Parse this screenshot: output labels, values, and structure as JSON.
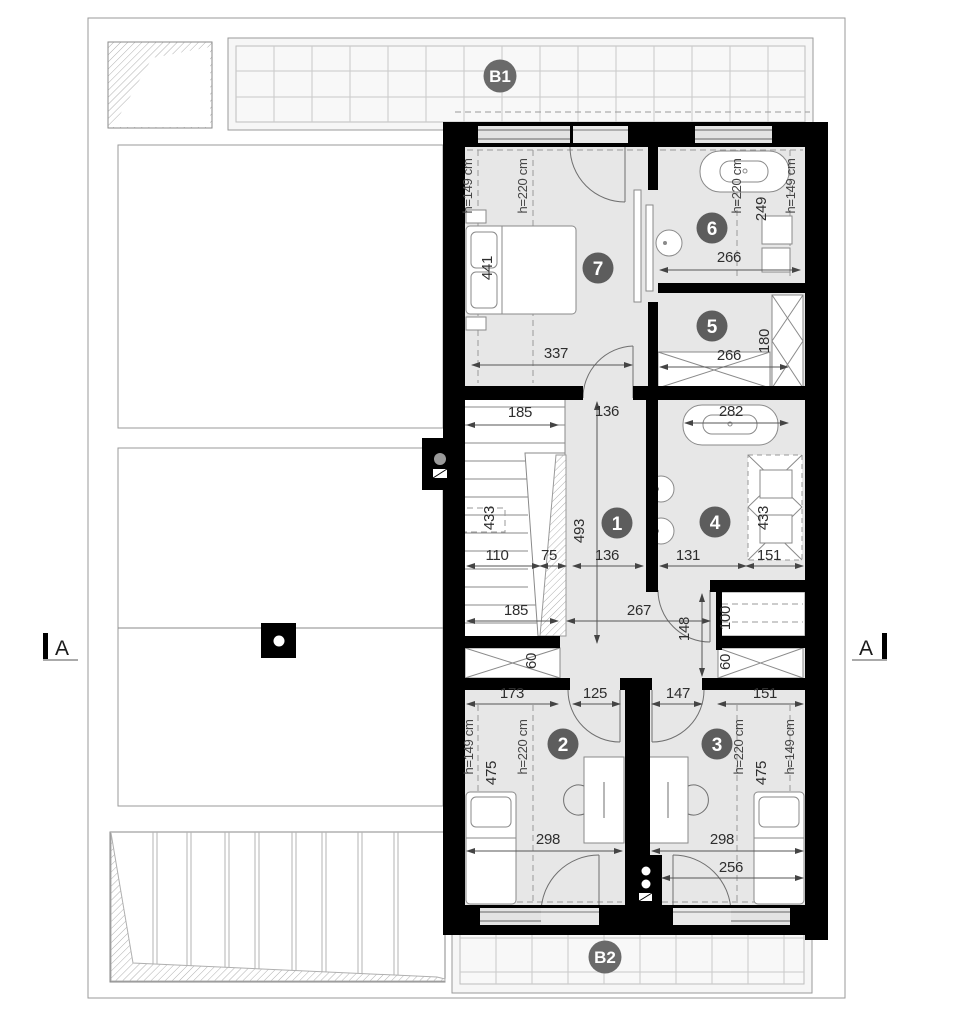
{
  "markers": {
    "b1": "B1",
    "b2": "B2",
    "section_left": "A",
    "section_right": "A"
  },
  "rooms": [
    "1",
    "2",
    "3",
    "4",
    "5",
    "6",
    "7"
  ],
  "dims": [
    "h=149 cm",
    "h=220 cm",
    "441",
    "337",
    "h=220 cm",
    "249",
    "h=149 cm",
    "266",
    "266",
    "180",
    "185",
    "136",
    "282",
    "433",
    "493",
    "110",
    "75",
    "136",
    "131",
    "151",
    "433",
    "185",
    "267",
    "148",
    "100",
    "60",
    "60",
    "173",
    "125",
    "147",
    "151",
    "h=149 cm",
    "h=220 cm",
    "475",
    "h=220 cm",
    "475",
    "h=149 cm",
    "298",
    "298",
    "256"
  ],
  "colors": {
    "wall": "#000000",
    "floor": "#e7e7e7",
    "marker_circle": "#5d5d5d",
    "line": "#8a8a8a"
  }
}
